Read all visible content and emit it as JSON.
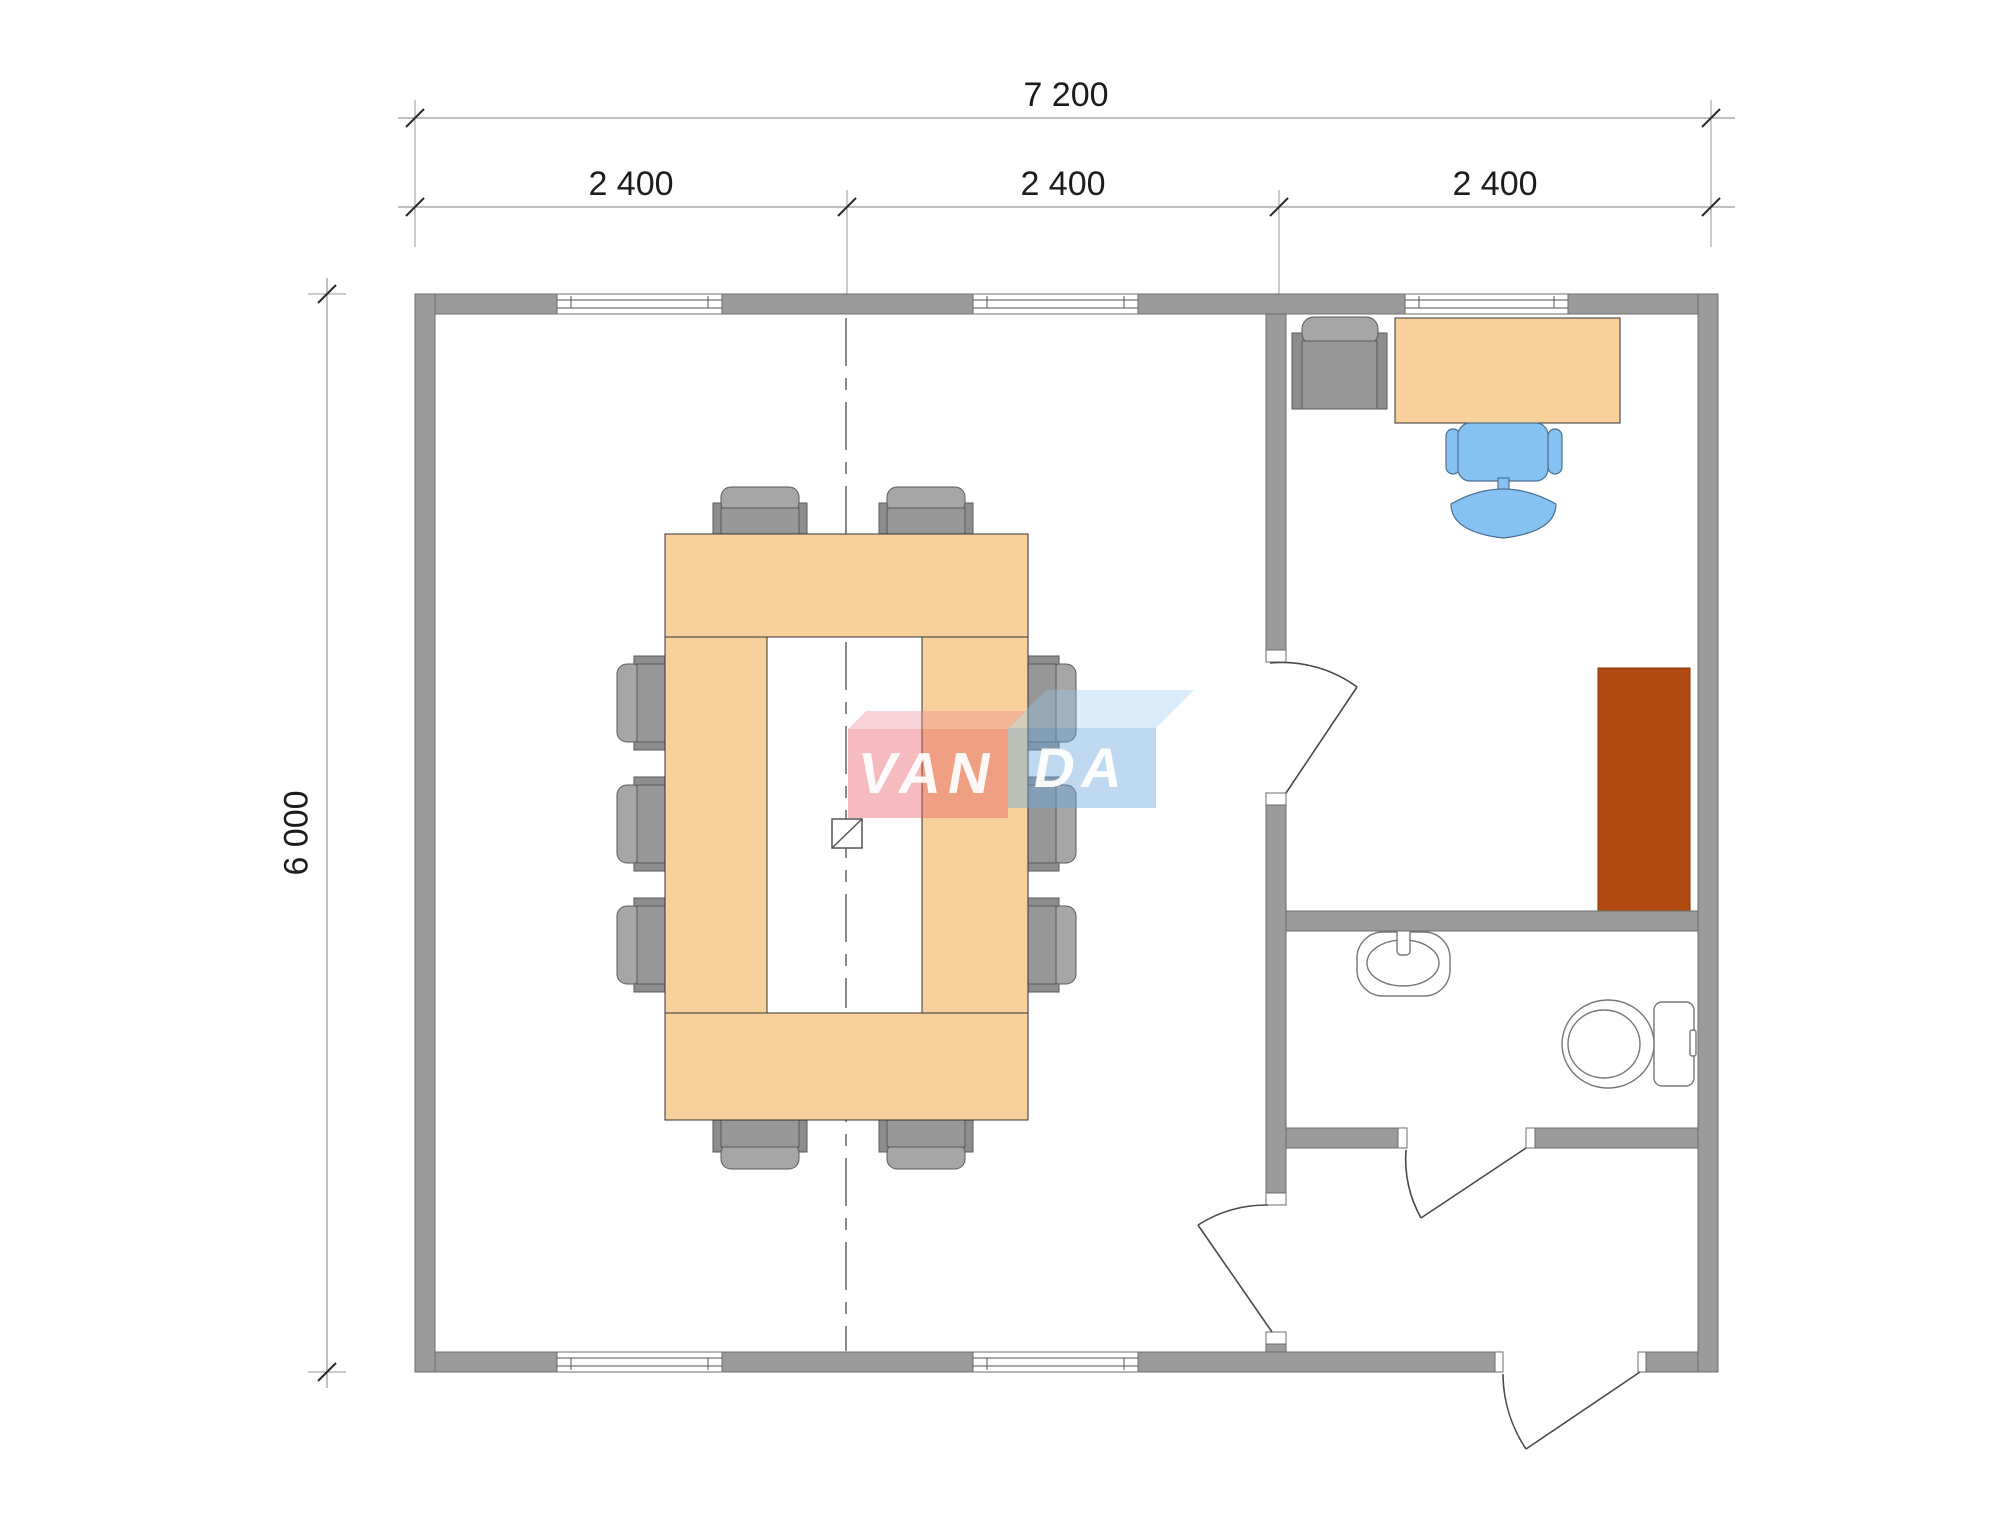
{
  "dimensions": {
    "total_width": "7 200",
    "modules": [
      "2 400",
      "2 400",
      "2 400"
    ],
    "total_height": "6 000"
  },
  "logo": {
    "text_left": "VAN",
    "text_right": "DA"
  },
  "colors": {
    "wall": "#9b9b9b",
    "wallStroke": "#6e6e6e",
    "furniturePeach": "#f8d09c",
    "chairGray": "#979797",
    "chairGrayDark": "#8d8d8d",
    "chairGrayLight": "#a6a6a6",
    "chairBlue": "#85c2f2",
    "chairBlueStroke": "#4d6f92",
    "cabinetBrown": "#b14a10",
    "cabinetBrownStroke": "#7d3509",
    "line": "#555555",
    "fixtureStroke": "#787878",
    "dimText": "#1c1c1c"
  }
}
